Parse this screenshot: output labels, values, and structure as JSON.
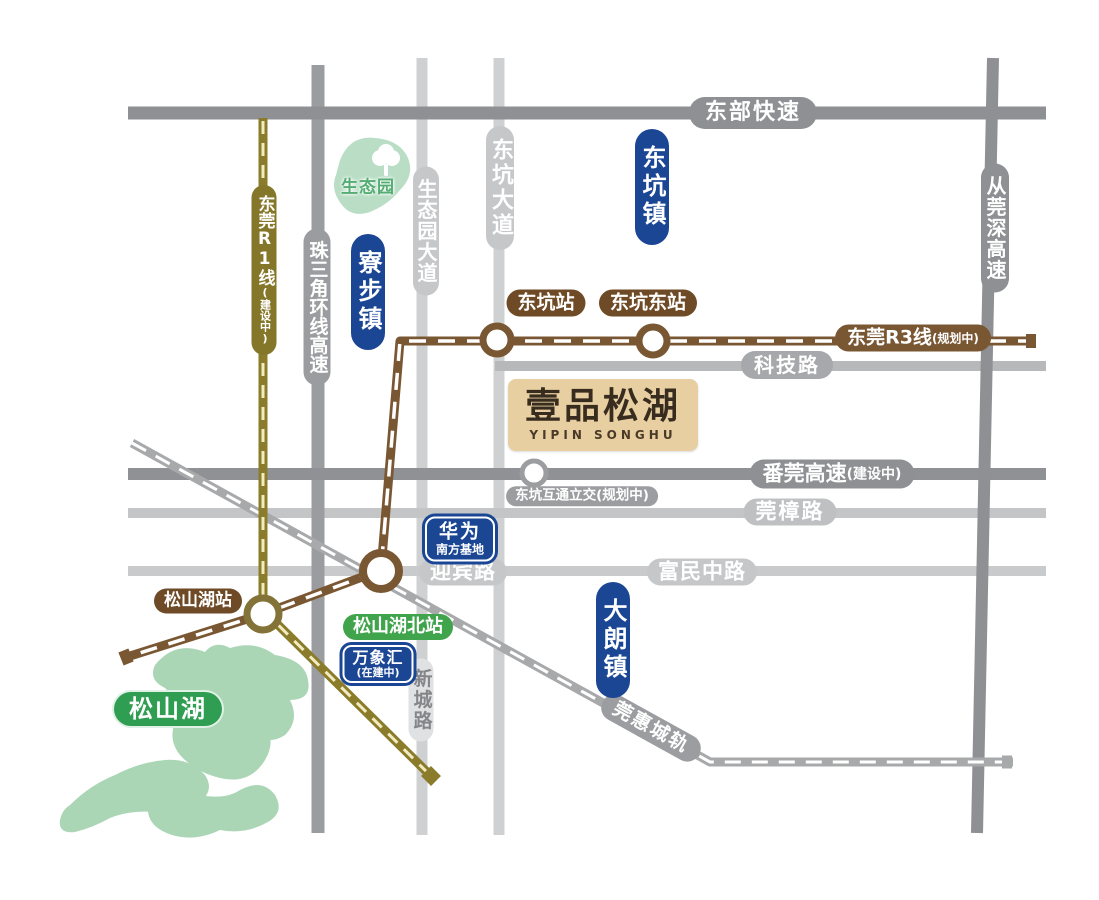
{
  "project": {
    "title": "壹品松湖",
    "subtitle": "YIPIN SONGHU"
  },
  "towns": {
    "dongkeng": "东坑镇",
    "liaobu": "寮步镇",
    "dalang": "大朗镇"
  },
  "roads": {
    "dongbu": "东部快速",
    "congguanshen": "从莞深高速",
    "zhusanjiao": "珠三角环线高速",
    "shengtaiyuan": "生态园大道",
    "dongkeng_ave": "东坑大道",
    "keji": "科技路",
    "fanguan": "番莞高速",
    "fanguan_note": "(建设中)",
    "guanzhang": "莞樟路",
    "yingbin": "迎宾路",
    "fumin": "富民中路",
    "xincheng": "新城路"
  },
  "rails": {
    "r1": "东莞R1线",
    "r1_note": "(建设中)",
    "r3": "东莞R3线",
    "r3_note": "(规划中)",
    "guanhui": "莞惠城轨"
  },
  "stations": {
    "dongkeng": "东坑站",
    "dongkeng_east": "东坑东站",
    "songshanhu": "松山湖站",
    "songshanhu_north": "松山湖北站",
    "interchange": "东坑互通立交(规划中)"
  },
  "pois": {
    "huawei": "华为",
    "huawei_sub": "南方基地",
    "mixc": "万象汇",
    "mixc_note": "(在建中)",
    "eco_park": "生态园",
    "lake": "松山湖"
  },
  "colors": {
    "town_badge_blue": "#1a4694",
    "metro_r1_olive": "#857729",
    "metro_r3_brown": "#7a5733",
    "station_badge_brown": "#6e4a26",
    "intercity_rail_gray": "#a8a9ab",
    "expressway_gray": "#8f9094",
    "road_light_gray": "#c6c7c9",
    "lake_green": "#abd6b6",
    "lake_badge_green": "#2f9e52",
    "station_badge_green": "#3fa44c",
    "project_box_tan": "#e8cfa2"
  }
}
